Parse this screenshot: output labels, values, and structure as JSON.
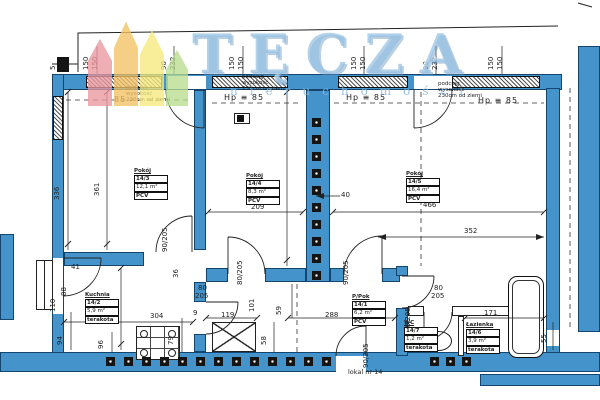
{
  "watermark": {
    "title": "TĘCZA",
    "subtitle": "nieruchomości",
    "stripe_colors": [
      "#e9979f",
      "#f3c265",
      "#f6e97c",
      "#b9dc8e"
    ],
    "text_color": "#96c1e2"
  },
  "plan": {
    "wall_color": "#4494cb",
    "unit_label": {
      "t": "lokal nr 14",
      "x": 348,
      "y": 368
    },
    "rooms": [
      {
        "title": "Pokój",
        "no": "14/3",
        "area": "12,1 m²",
        "floor": "PCV",
        "x": 134,
        "y": 168
      },
      {
        "title": "Pokój",
        "no": "14/4",
        "area": "8,3 m²",
        "floor": "PCV",
        "x": 246,
        "y": 173
      },
      {
        "title": "Pokój",
        "no": "14/5",
        "area": "16,4 m²",
        "floor": "PCV",
        "x": 406,
        "y": 171
      },
      {
        "title": "Kuchnia",
        "no": "14/2",
        "area": "5,9 m²",
        "floor": "terakota",
        "x": 85,
        "y": 292
      },
      {
        "title": "P/Pok",
        "no": "14/1",
        "area": "6,2 m²",
        "floor": "PCV",
        "x": 352,
        "y": 294
      },
      {
        "title": "WC",
        "no": "14/7",
        "area": "1,2 m²",
        "floor": "terakota",
        "x": 404,
        "y": 320
      },
      {
        "title": "Łazienka",
        "no": "14/6",
        "area": "3,9 m²",
        "floor": "terakota",
        "x": 466,
        "y": 322
      }
    ],
    "notes": [
      {
        "lines": [
          "podciąg",
          "wysokość",
          "230cm od ziemi"
        ],
        "x": 126,
        "y": 85
      },
      {
        "lines": [
          "podciąg",
          "wysokość",
          "230cm od ziemi"
        ],
        "x": 242,
        "y": 74
      },
      {
        "lines": [
          "podciąg",
          "wysokość",
          "230cm od ziemi"
        ],
        "x": 438,
        "y": 81
      }
    ],
    "hp_labels": [
      {
        "t": "85",
        "x": 114,
        "y": 95
      },
      {
        "t": "Hp ≡ 85",
        "x": 224,
        "y": 93
      },
      {
        "t": "Hp ≡ 85",
        "x": 346,
        "y": 93
      },
      {
        "t": "Hp ≡ 85",
        "x": 478,
        "y": 96
      }
    ],
    "dims": [
      {
        "t": "150",
        "x": 91,
        "y": 70,
        "r": 1
      },
      {
        "t": "150",
        "x": 100,
        "y": 70,
        "r": 1
      },
      {
        "t": "90",
        "x": 169,
        "y": 70,
        "r": 1
      },
      {
        "t": "232",
        "x": 178,
        "y": 70,
        "r": 1
      },
      {
        "t": "150",
        "x": 237,
        "y": 70,
        "r": 1
      },
      {
        "t": "150",
        "x": 246,
        "y": 70,
        "r": 1
      },
      {
        "t": "150",
        "x": 359,
        "y": 70,
        "r": 1
      },
      {
        "t": "150",
        "x": 368,
        "y": 70,
        "r": 1
      },
      {
        "t": "90",
        "x": 431,
        "y": 70,
        "r": 1
      },
      {
        "t": "232",
        "x": 440,
        "y": 70,
        "r": 1
      },
      {
        "t": "150",
        "x": 496,
        "y": 70,
        "r": 1
      },
      {
        "t": "150",
        "x": 505,
        "y": 70,
        "r": 1
      },
      {
        "t": "5",
        "x": 58,
        "y": 70,
        "r": 1
      },
      {
        "t": "336",
        "x": 62,
        "y": 200,
        "r": 1
      },
      {
        "t": "361",
        "x": 102,
        "y": 196,
        "r": 1
      },
      {
        "t": "397",
        "x": 281,
        "y": 200,
        "r": 1
      },
      {
        "t": "209",
        "x": 251,
        "y": 202
      },
      {
        "t": "466",
        "x": 423,
        "y": 200
      },
      {
        "t": "352",
        "x": 464,
        "y": 226
      },
      {
        "t": "40",
        "x": 341,
        "y": 190
      },
      {
        "t": "90/205",
        "x": 170,
        "y": 252,
        "r": 1
      },
      {
        "t": "80/205",
        "x": 245,
        "y": 285,
        "r": 1
      },
      {
        "t": "90/205",
        "x": 351,
        "y": 285,
        "r": 1
      },
      {
        "t": "36",
        "x": 181,
        "y": 278,
        "r": 1
      },
      {
        "t": "80",
        "x": 198,
        "y": 283
      },
      {
        "t": "205",
        "x": 195,
        "y": 291
      },
      {
        "t": "9",
        "x": 193,
        "y": 308
      },
      {
        "t": "304",
        "x": 150,
        "y": 311
      },
      {
        "t": "195",
        "x": 114,
        "y": 316,
        "r": 1
      },
      {
        "t": "88",
        "x": 69,
        "y": 296,
        "r": 1
      },
      {
        "t": "110",
        "x": 58,
        "y": 312,
        "r": 1
      },
      {
        "t": "41",
        "x": 71,
        "y": 262
      },
      {
        "t": "94",
        "x": 65,
        "y": 345,
        "r": 1
      },
      {
        "t": "96",
        "x": 106,
        "y": 349,
        "r": 1
      },
      {
        "t": "79",
        "x": 176,
        "y": 345,
        "r": 1
      },
      {
        "t": "101",
        "x": 257,
        "y": 312,
        "r": 1
      },
      {
        "t": "59",
        "x": 284,
        "y": 315,
        "r": 1
      },
      {
        "t": "119",
        "x": 221,
        "y": 310
      },
      {
        "t": "288",
        "x": 325,
        "y": 310
      },
      {
        "t": "58",
        "x": 269,
        "y": 345,
        "r": 1
      },
      {
        "t": "80",
        "x": 434,
        "y": 283
      },
      {
        "t": "205",
        "x": 431,
        "y": 291
      },
      {
        "t": "70/205",
        "x": 413,
        "y": 332,
        "r": 1
      },
      {
        "t": "90/205",
        "x": 371,
        "y": 368,
        "r": 1
      },
      {
        "t": "171",
        "x": 484,
        "y": 308
      },
      {
        "t": "55",
        "x": 549,
        "y": 343,
        "r": 1
      }
    ],
    "flues": [
      {
        "x": 106,
        "y": 357,
        "n": 13,
        "s": 18,
        "v": 0
      },
      {
        "x": 430,
        "y": 357,
        "n": 3,
        "s": 16,
        "v": 0
      },
      {
        "x": 312,
        "y": 118,
        "n": 10,
        "s": 17,
        "v": 1
      }
    ]
  }
}
